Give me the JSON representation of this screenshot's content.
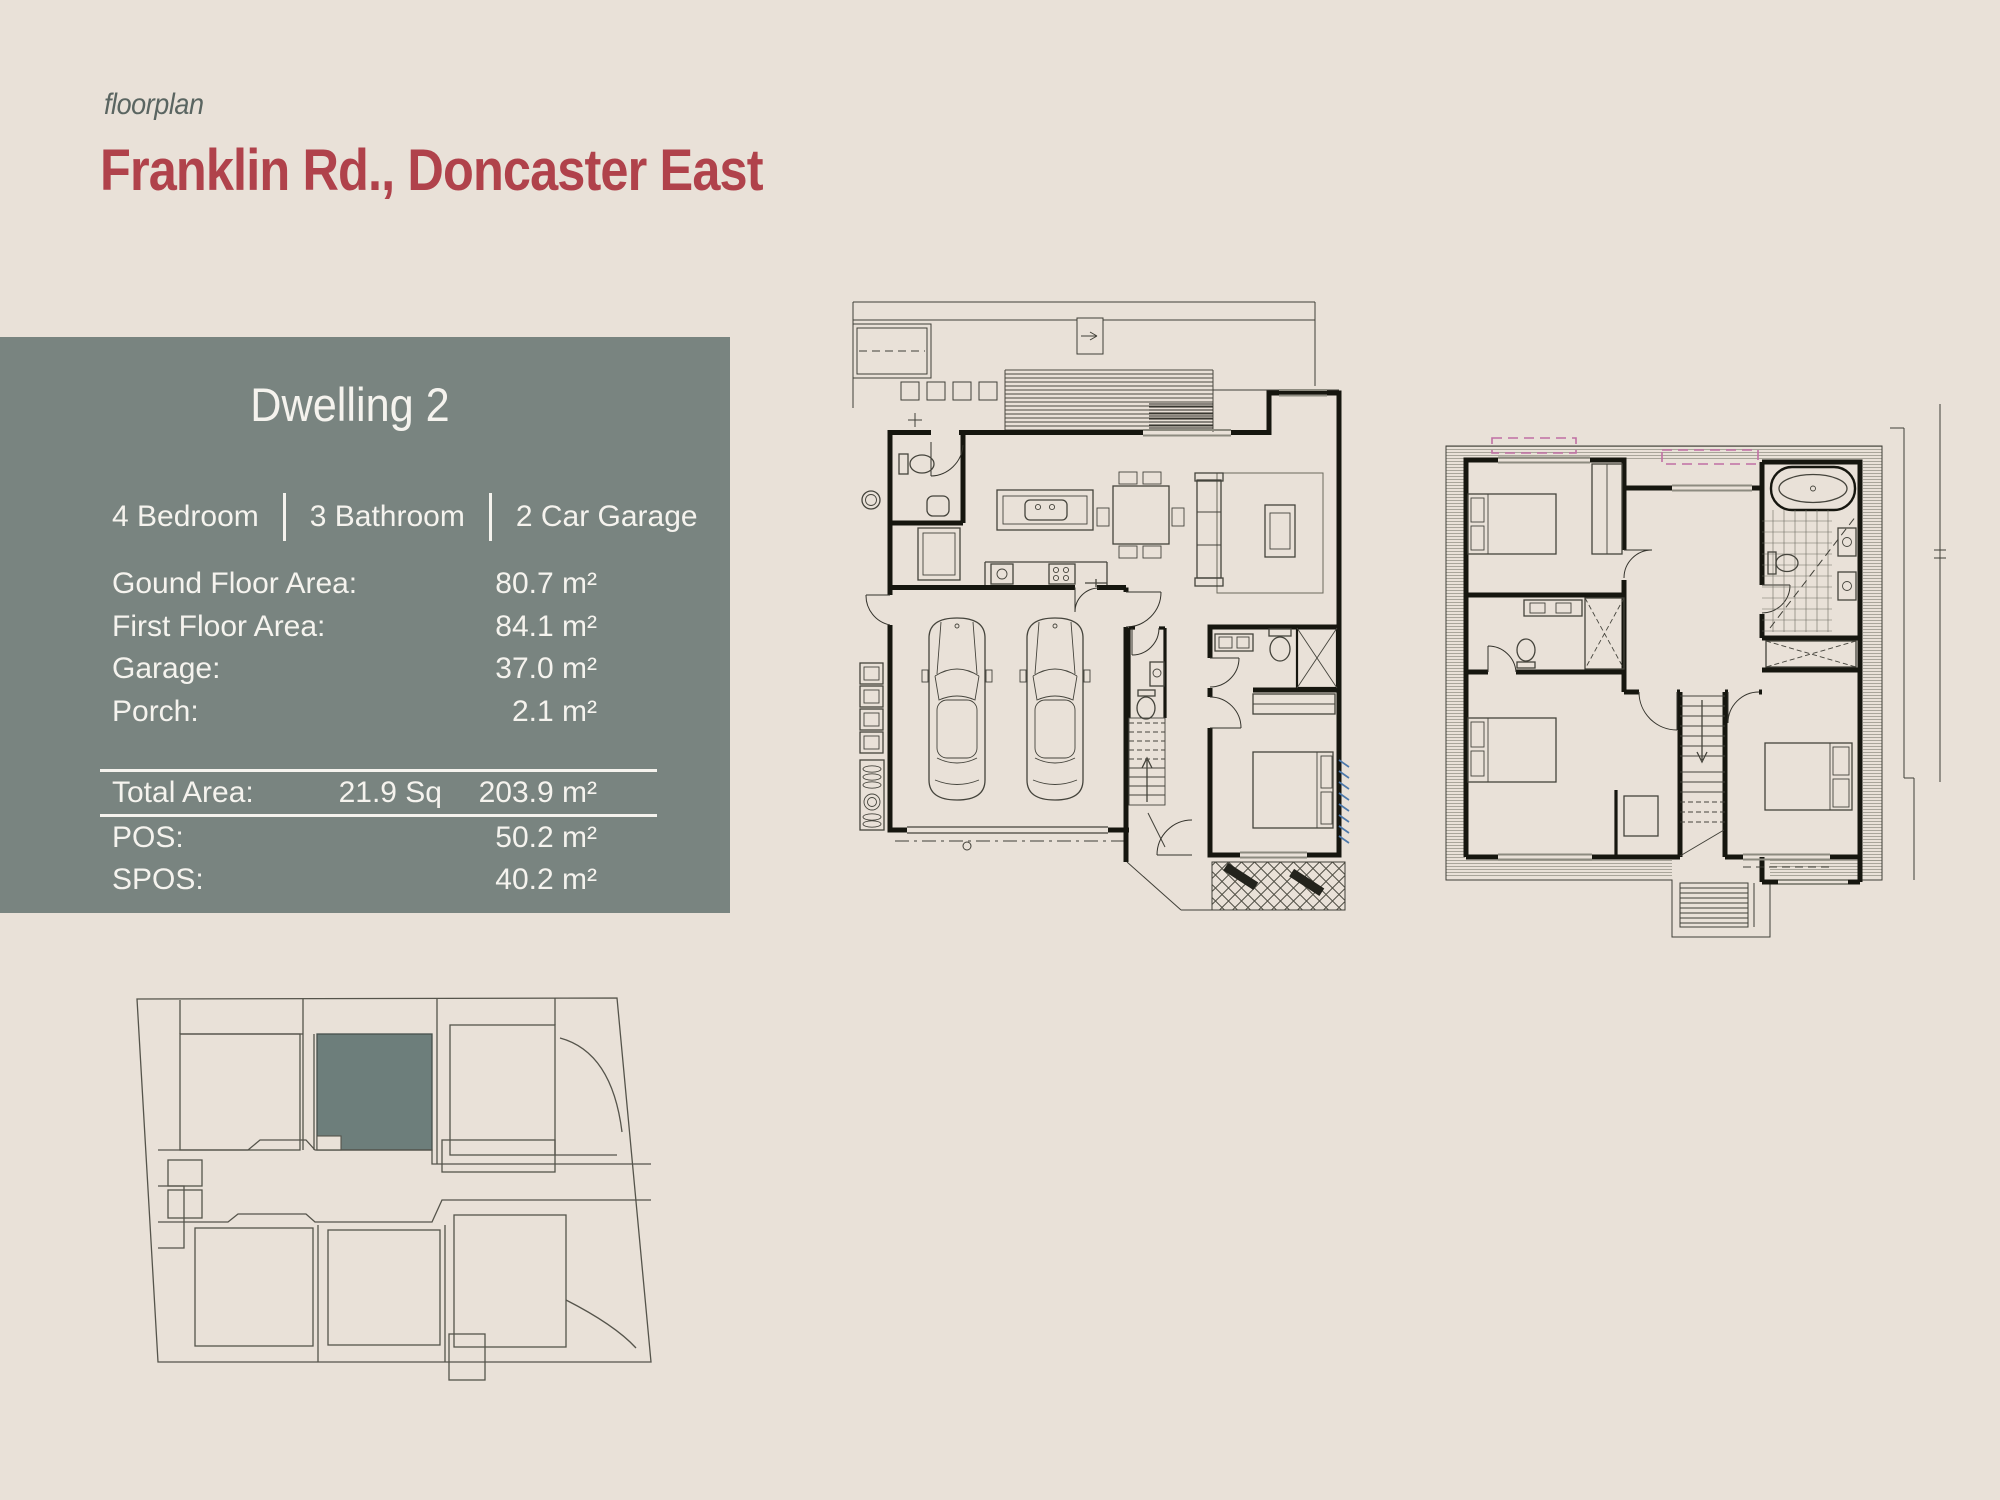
{
  "page": {
    "eyebrow": "floorplan",
    "title": "Franklin Rd., Doncaster East"
  },
  "info_box": {
    "title": "Dwelling 2",
    "features": [
      {
        "label": "4 Bedroom"
      },
      {
        "label": "3 Bathroom"
      },
      {
        "label": "2 Car Garage"
      }
    ],
    "areas": [
      {
        "label": "Gound Floor Area:",
        "value": "80.7 m²"
      },
      {
        "label": "First Floor Area:",
        "value": "84.1 m²"
      },
      {
        "label": "Garage:",
        "value": "37.0 m²"
      },
      {
        "label": "Porch:",
        "value": "2.1 m²"
      }
    ],
    "totals": {
      "total": {
        "label": "Total Area:",
        "squares": "21.9 Sq",
        "value": "203.9 m²"
      },
      "pos": {
        "label": "POS:",
        "squares": "",
        "value": "50.2 m²"
      },
      "spos": {
        "label": "SPOS:",
        "squares": "",
        "value": "40.2 m²"
      }
    }
  },
  "colors": {
    "background": "#e9e1d8",
    "panel": "#798480",
    "panel_text": "#f5f3ee",
    "accent_red": "#b0424b",
    "eyebrow_gray": "#5a6561",
    "highlighted_unit": "#6d7e7b",
    "plan_line": "#16160f",
    "window_pink": "#c06fa4",
    "hatch_blue": "#4d79ab"
  }
}
